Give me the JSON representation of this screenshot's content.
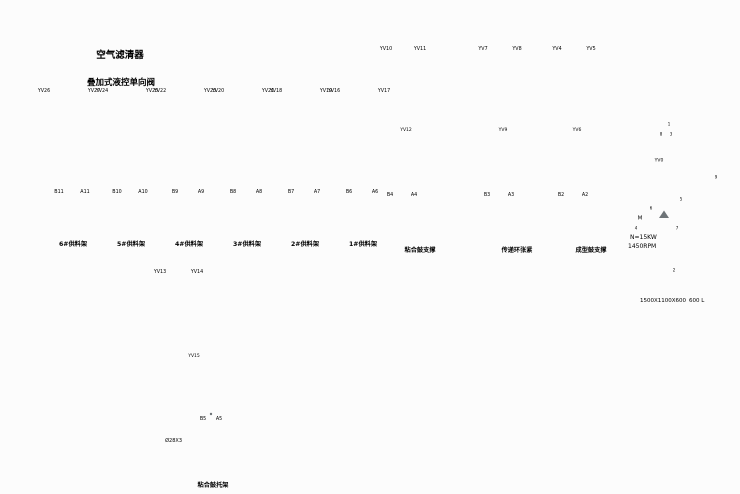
{
  "page": {
    "background": "#fcfcfc",
    "line_color": "#b3b9be",
    "label_color": "#8f959a",
    "caption_color": "#4a4f53",
    "dark_line": "#6e7478"
  },
  "annotations": {
    "air_filter": "空气滤清器",
    "stacked_pilot_check": "叠加式液控单向阀"
  },
  "stations": [
    {
      "yv_left": "YV26",
      "yv_right": "YV27",
      "port_b": "B11",
      "port_a": "A11",
      "caption": "6#供料架"
    },
    {
      "yv_left": "YV24",
      "yv_right": "YV25",
      "port_b": "B10",
      "port_a": "A10",
      "caption": "5#供料架"
    },
    {
      "yv_left": "YV22",
      "yv_right": "YV23",
      "port_b": "B9",
      "port_a": "A9",
      "caption": "4#供料架"
    },
    {
      "yv_left": "YV20",
      "yv_right": "YV21",
      "port_b": "B8",
      "port_a": "A8",
      "caption": "3#供料架"
    },
    {
      "yv_left": "YV18",
      "yv_right": "YV19",
      "port_b": "B7",
      "port_a": "A7",
      "caption": "2#供料架"
    },
    {
      "yv_left": "YV16",
      "yv_right": "YV17",
      "port_b": "B6",
      "port_a": "A6",
      "caption": "1#供料架"
    }
  ],
  "assemblies": [
    {
      "yv_left": "YV10",
      "yv_right": "YV11",
      "yv_mid": "YV12",
      "port_b": "B4",
      "port_a": "A4",
      "caption": "粘合鼓支撑"
    },
    {
      "yv_left": "YV7",
      "yv_right": "YV8",
      "yv_mid": "YV9",
      "port_b": "B3",
      "port_a": "A3",
      "caption": "传递环张紧"
    },
    {
      "yv_left": "YV4",
      "yv_right": "YV5",
      "yv_mid": "YV6",
      "port_b": "B2",
      "port_a": "A2",
      "caption": "成型鼓支撑"
    }
  ],
  "bottom_assembly": {
    "yv_left": "YV13",
    "yv_right": "YV14",
    "yv_mid": "YV15",
    "port_b": "B5",
    "port_a": "A5",
    "cylinder_spec": "Ø28X3",
    "caption": "粘合鼓托架"
  },
  "power_unit": {
    "valve_label": "YV0",
    "motor_letter": "M",
    "motor_power": "N=15KW",
    "motor_rpm": "1450RPM",
    "tank_size": "1500X1100X600",
    "tank_volume": "600 L",
    "balloons": [
      "1",
      "8",
      "3",
      "5",
      "6",
      "7",
      "4",
      "2",
      "9"
    ]
  }
}
